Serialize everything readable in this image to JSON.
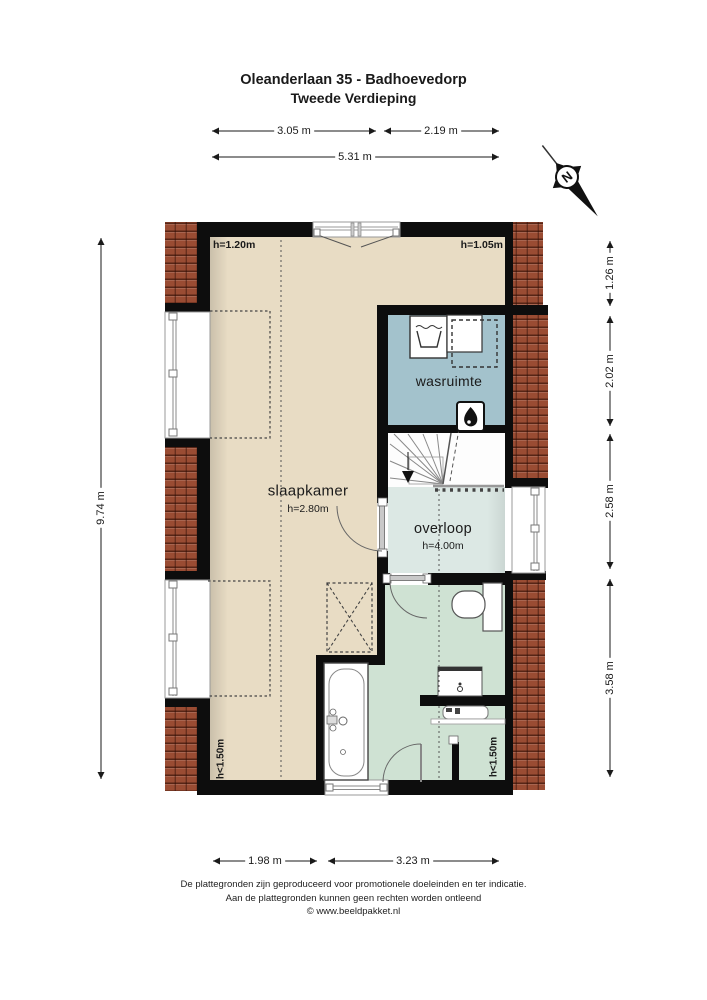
{
  "title": {
    "line1": "Oleanderlaan 35 - Badhoevedorp",
    "line2": "Tweede Verdieping"
  },
  "compass": {
    "label": "N"
  },
  "dimensions": {
    "top": {
      "seg1": "3.05 m",
      "seg2": "2.19 m",
      "total": "5.31 m"
    },
    "bottom": {
      "seg1": "1.98 m",
      "seg2": "3.23 m"
    },
    "left": {
      "total": "9.74 m"
    },
    "right": {
      "seg1": "1.26 m",
      "seg2": "2.02 m",
      "seg3": "2.58 m",
      "seg4": "3.58 m"
    }
  },
  "rooms": {
    "slaapkamer": {
      "label": "slaapkamer",
      "height": "h=2.80m"
    },
    "wasruimte": {
      "label": "wasruimte"
    },
    "overloop": {
      "label": "overloop",
      "height": "h=4.00m"
    }
  },
  "annotations": {
    "top_left_height": "h=1.20m",
    "top_right_height": "h=1.05m",
    "bottom_left_height": "h<1.50m",
    "bottom_right_height": "h<1.50m"
  },
  "footer": {
    "line1": "De plattegronden zijn geproduceerd voor promotionele doeleinden en ter indicatie.",
    "line2": "Aan de plattegronden kunnen geen rechten worden ontleend",
    "line3": "© www.beeldpakket.nl"
  },
  "colors": {
    "wall": "#0d0d0d",
    "slaapkamer_floor": "#e8dcc4",
    "wasruimte_floor": "#a3c2cc",
    "overloop_floor": "#dce8e4",
    "badkamer_floor": "#cfe2d3",
    "stairs_floor": "#fdfdfd",
    "roof_tile": "#9a4c33"
  },
  "icons": {
    "compass": "compass-north-icon",
    "boiler": "flame-icon",
    "washer": "laundry-tub-icon",
    "stairs_direction": "down-arrow-icon"
  }
}
